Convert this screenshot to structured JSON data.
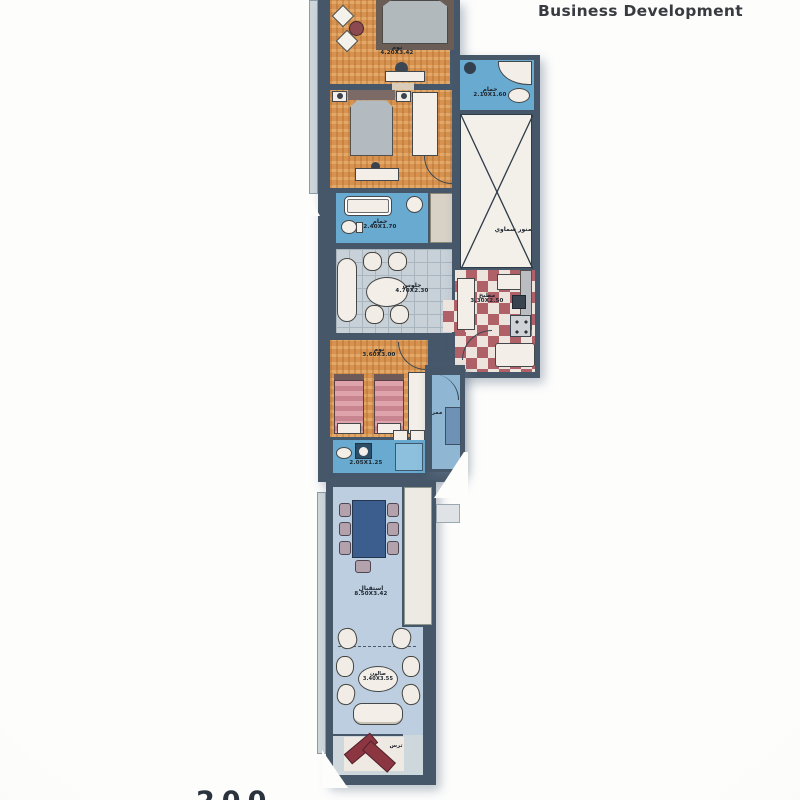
{
  "header": {
    "title": "Business Development"
  },
  "footer": {
    "partial_text": "200"
  },
  "palette": {
    "wall": "#46576a",
    "wood_floor": "#d6924e",
    "bath_floor": "#68aad0",
    "tile_floor": "#c9d1d8",
    "kitchen_checker_red": "#b06067",
    "reception_floor": "#bccee0",
    "light_well": "#f3f0e9",
    "accent_red_sofa": "#8c3642",
    "dining_table_blue": "#3b5e8e"
  },
  "rooms": {
    "bedroom1": {
      "name": "نوم",
      "dims": "4.20X3.42"
    },
    "bathroom1": {
      "name": "حمام",
      "dims": "2.40X1.70"
    },
    "sitting": {
      "name": "جلوس",
      "dims": "4.70X2.30"
    },
    "bedroom3": {
      "name": "نوم",
      "dims": "3.60X3.00"
    },
    "bathroom2": {
      "name": "حمام",
      "dims": "2.05X1.25"
    },
    "reception": {
      "name": "استقبال",
      "dims": "8.50X3.42"
    },
    "salon": {
      "name": "صالون",
      "dims": "3.40X3.55"
    },
    "terrace": {
      "name": "ترس"
    },
    "hall": {
      "name": "ممر"
    },
    "annex_bathroom": {
      "name": "حمام",
      "dims": "2.10X1.60"
    },
    "light_well": {
      "name": "منور سماوي"
    },
    "kitchen": {
      "name": "مطبخ",
      "dims": "3.30X2.50"
    }
  }
}
